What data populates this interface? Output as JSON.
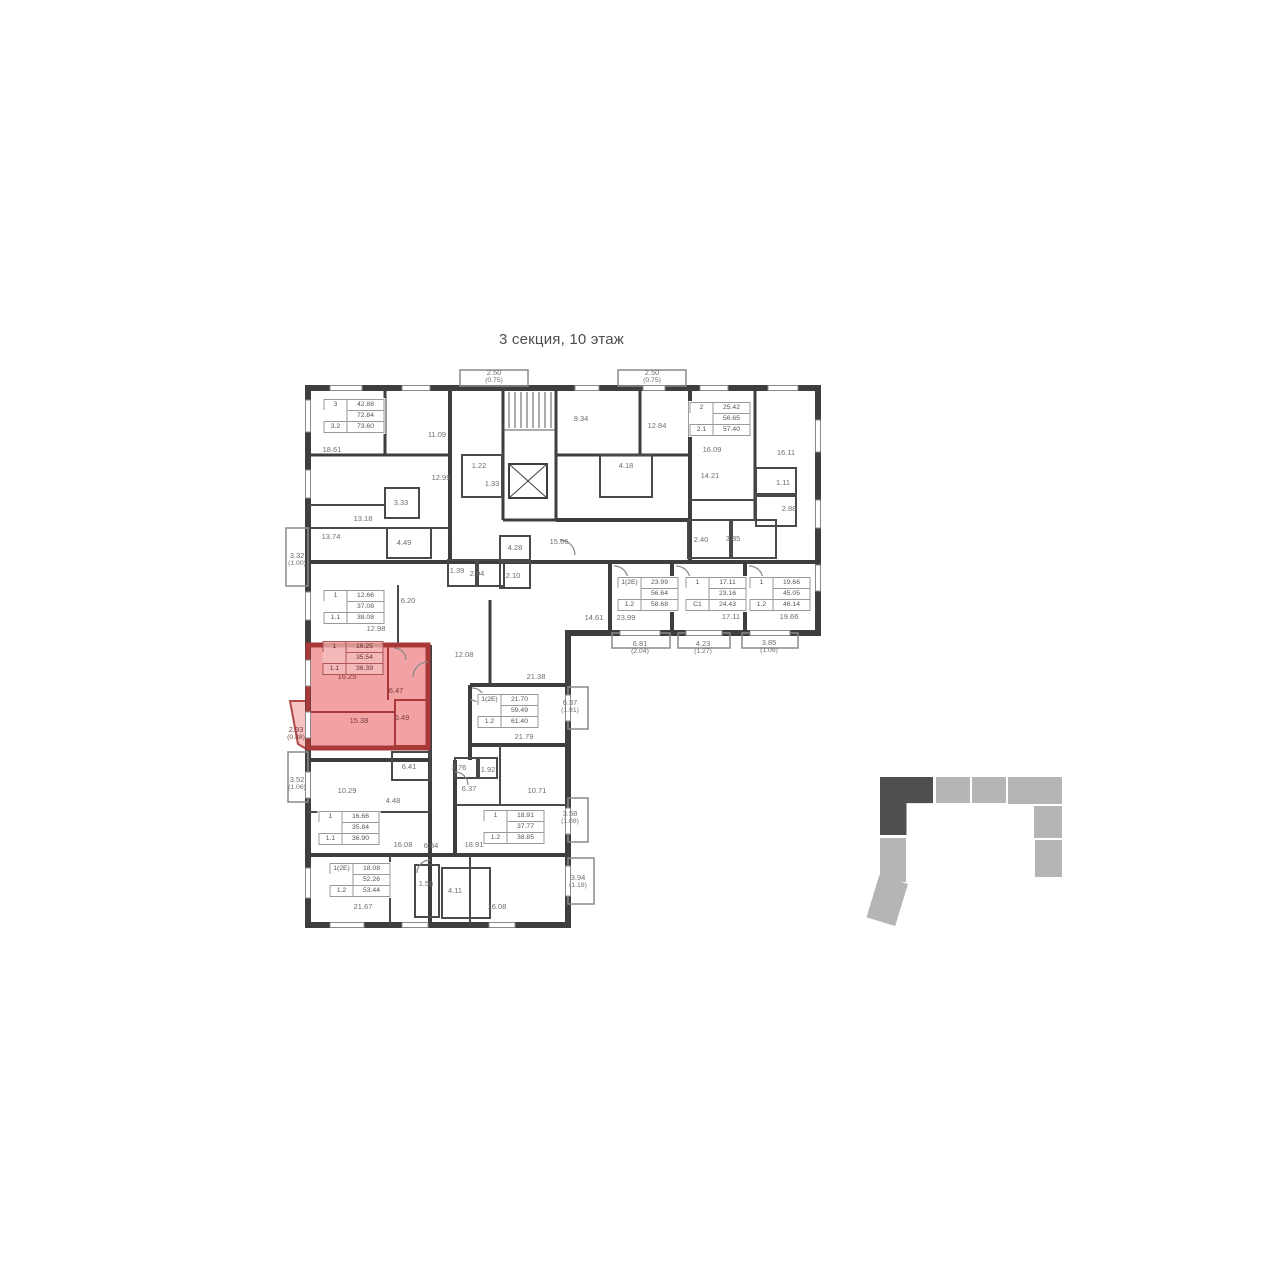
{
  "page": {
    "title": "3 секция, 10 этаж"
  },
  "floorplan": {
    "highlight_fill": "#f2a2a2",
    "highlight_wall": "#a93939",
    "selected_apartment": {
      "rooms_label": "1",
      "living_area": "16.25",
      "area": "35.54",
      "type": "1.1",
      "total_area": "36.39"
    },
    "apartments": [
      {
        "x": 354,
        "y": 416,
        "rows": [
          [
            "3",
            "42.88"
          ],
          [
            "",
            "72.84"
          ],
          [
            "3.2",
            "73.60"
          ]
        ]
      },
      {
        "x": 720,
        "y": 419,
        "rows": [
          [
            "2",
            "25.42"
          ],
          [
            "",
            "56.65"
          ],
          [
            "2.1",
            "57.40"
          ]
        ]
      },
      {
        "x": 354,
        "y": 607,
        "rows": [
          [
            "1",
            "12.66"
          ],
          [
            "",
            "37.08"
          ],
          [
            "1.1",
            "38.08"
          ]
        ]
      },
      {
        "x": 353,
        "y": 658,
        "red": true,
        "rows": [
          [
            "1",
            "16.25"
          ],
          [
            "",
            "35.54"
          ],
          [
            "1.1",
            "36.39"
          ]
        ]
      },
      {
        "x": 648,
        "y": 594,
        "rows": [
          [
            "1(2Е)",
            "23.99"
          ],
          [
            "",
            "56.64"
          ],
          [
            "1.2",
            "58.68"
          ]
        ]
      },
      {
        "x": 716,
        "y": 594,
        "rows": [
          [
            "1",
            "17.11"
          ],
          [
            "",
            "23.16"
          ],
          [
            "С1",
            "24.43"
          ]
        ]
      },
      {
        "x": 780,
        "y": 594,
        "rows": [
          [
            "1",
            "19.66"
          ],
          [
            "",
            "45.05"
          ],
          [
            "1.2",
            "46.14"
          ]
        ]
      },
      {
        "x": 508,
        "y": 711,
        "rows": [
          [
            "1(2Е)",
            "21.70"
          ],
          [
            "",
            "59.49"
          ],
          [
            "1.2",
            "61.40"
          ]
        ]
      },
      {
        "x": 349,
        "y": 828,
        "rows": [
          [
            "1",
            "16.66"
          ],
          [
            "",
            "35.84"
          ],
          [
            "1.1",
            "36.90"
          ]
        ]
      },
      {
        "x": 514,
        "y": 827,
        "rows": [
          [
            "1",
            "18.91"
          ],
          [
            "",
            "37.77"
          ],
          [
            "1.2",
            "38.85"
          ]
        ]
      },
      {
        "x": 360,
        "y": 880,
        "rows": [
          [
            "1(2Е)",
            "18.08"
          ],
          [
            "",
            "52.26"
          ],
          [
            "1.2",
            "53.44"
          ]
        ]
      }
    ],
    "room_labels": [
      {
        "t": "18.61",
        "x": 332,
        "y": 450
      },
      {
        "t": "11.09",
        "x": 437,
        "y": 435
      },
      {
        "t": "12.99",
        "x": 441,
        "y": 478
      },
      {
        "t": "1.22",
        "x": 479,
        "y": 466
      },
      {
        "t": "1.33",
        "x": 492,
        "y": 484
      },
      {
        "t": "3.33",
        "x": 401,
        "y": 503
      },
      {
        "t": "13.18",
        "x": 363,
        "y": 519
      },
      {
        "t": "13.74",
        "x": 331,
        "y": 537
      },
      {
        "t": "4.49",
        "x": 404,
        "y": 543
      },
      {
        "t": "2.50",
        "s": "(0.75)",
        "x": 494,
        "y": 377
      },
      {
        "t": "9.34",
        "x": 581,
        "y": 419
      },
      {
        "t": "2.50",
        "s": "(0.75)",
        "x": 652,
        "y": 377
      },
      {
        "t": "12.84",
        "x": 657,
        "y": 426
      },
      {
        "t": "4.18",
        "x": 626,
        "y": 466
      },
      {
        "t": "16.09",
        "x": 712,
        "y": 450
      },
      {
        "t": "14.21",
        "x": 710,
        "y": 476
      },
      {
        "t": "16.11",
        "x": 786,
        "y": 453
      },
      {
        "t": "1.11",
        "x": 783,
        "y": 483
      },
      {
        "t": "2.88",
        "x": 789,
        "y": 509
      },
      {
        "t": "2.40",
        "x": 701,
        "y": 540
      },
      {
        "t": "3.85",
        "x": 733,
        "y": 539
      },
      {
        "t": "15.66",
        "x": 559,
        "y": 542
      },
      {
        "t": "1.39",
        "x": 457,
        "y": 571
      },
      {
        "t": "2.94",
        "x": 477,
        "y": 574
      },
      {
        "t": "4.28",
        "x": 515,
        "y": 548
      },
      {
        "t": "2.10",
        "x": 513,
        "y": 576
      },
      {
        "t": "14.61",
        "x": 594,
        "y": 618
      },
      {
        "t": "23.99",
        "x": 626,
        "y": 618
      },
      {
        "t": "17.11",
        "x": 731,
        "y": 617
      },
      {
        "t": "19.66",
        "x": 789,
        "y": 617
      },
      {
        "t": "6.81",
        "s": "(2.04)",
        "x": 640,
        "y": 648
      },
      {
        "t": "4.23",
        "s": "(1.27)",
        "x": 703,
        "y": 648
      },
      {
        "t": "3.85",
        "s": "(1.08)",
        "x": 769,
        "y": 647
      },
      {
        "t": "3.32",
        "s": "(1.00)",
        "x": 297,
        "y": 560
      },
      {
        "t": "6.20",
        "x": 408,
        "y": 601
      },
      {
        "t": "12.98",
        "x": 376,
        "y": 629
      },
      {
        "t": "12.08",
        "x": 464,
        "y": 655
      },
      {
        "t": "21.38",
        "x": 536,
        "y": 677
      },
      {
        "t": "16.25",
        "x": 347,
        "y": 677,
        "red": true
      },
      {
        "t": "6.47",
        "x": 396,
        "y": 691,
        "red": true
      },
      {
        "t": "15.38",
        "x": 359,
        "y": 721,
        "red": true
      },
      {
        "t": "6.49",
        "x": 402,
        "y": 718,
        "red": true
      },
      {
        "t": "2.93",
        "s": "(0.88)",
        "x": 296,
        "y": 734,
        "red": true
      },
      {
        "t": "3.52",
        "s": "(1.06)",
        "x": 297,
        "y": 784
      },
      {
        "t": "10.29",
        "x": 347,
        "y": 791
      },
      {
        "t": "6.41",
        "x": 409,
        "y": 767
      },
      {
        "t": "4.48",
        "x": 393,
        "y": 801
      },
      {
        "t": "2.76",
        "x": 459,
        "y": 768
      },
      {
        "t": "1.92",
        "x": 488,
        "y": 770
      },
      {
        "t": "6.37",
        "x": 469,
        "y": 789
      },
      {
        "t": "10.71",
        "x": 537,
        "y": 791
      },
      {
        "t": "21.79",
        "x": 524,
        "y": 737
      },
      {
        "t": "6.37",
        "s": "(1.91)",
        "x": 570,
        "y": 707
      },
      {
        "t": "3.58",
        "s": "(1.08)",
        "x": 570,
        "y": 818
      },
      {
        "t": "16.08",
        "x": 403,
        "y": 845
      },
      {
        "t": "6.84",
        "x": 431,
        "y": 846
      },
      {
        "t": "18.91",
        "x": 474,
        "y": 845
      },
      {
        "t": "21.67",
        "x": 363,
        "y": 907
      },
      {
        "t": "1.56",
        "x": 426,
        "y": 884
      },
      {
        "t": "4.11",
        "x": 455,
        "y": 891
      },
      {
        "t": "16.08",
        "x": 497,
        "y": 907
      },
      {
        "t": "3.94",
        "s": "(1.18)",
        "x": 578,
        "y": 882
      }
    ]
  },
  "minimap": {
    "active_color": "#4f4f4f",
    "inactive_color": "#b5b5b5",
    "active_section": "3"
  }
}
